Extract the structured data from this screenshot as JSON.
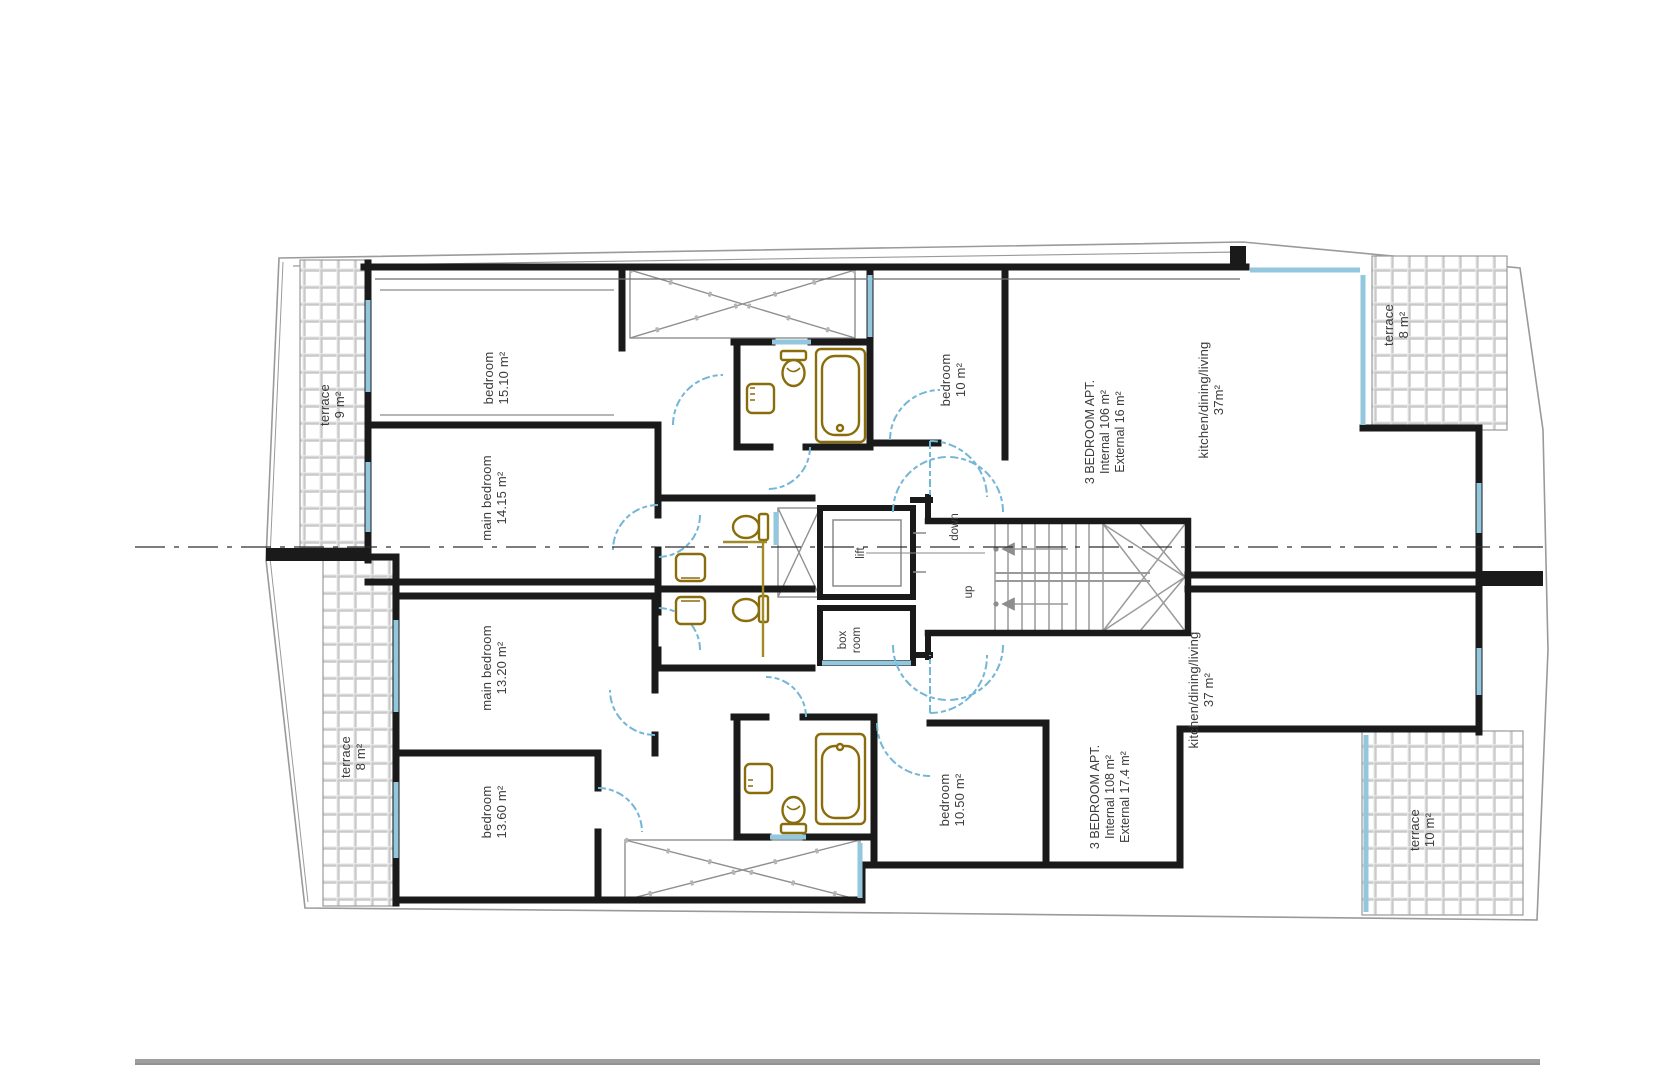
{
  "title": "apartment floor plan",
  "colors": {
    "wall": "#1a1a1a",
    "glazing": "#92c7de",
    "door_swing": "#74b6d6",
    "fixture": "#8a6d0b",
    "tile_grout": "#c9c9c9",
    "boundary": "#9a9a9a",
    "label_text": "#3b3b3b"
  },
  "labels": {
    "terrace_tl": {
      "name": "terrace",
      "area": "9 m²"
    },
    "bedroom_1510": {
      "name": "bedroom",
      "area": "15.10 m²"
    },
    "main_bedroom_1415": {
      "name": "main bedroom",
      "area": "14.15 m²"
    },
    "main_bedroom_1320": {
      "name": "main bedroom",
      "area": "13.20 m²"
    },
    "bedroom_1360": {
      "name": "bedroom",
      "area": "13.60 m²"
    },
    "terrace_bl": {
      "name": "terrace",
      "area": "8 m²"
    },
    "bedroom_10": {
      "name": "bedroom",
      "area": "10 m²"
    },
    "apt_upper": {
      "l1": "3 BEDROOM APT.",
      "l2": "Internal 106  m²",
      "l3": "External 16 m²"
    },
    "kitchen_upper": {
      "name": "kitchen/dining/living",
      "area": "37m²"
    },
    "terrace_tr": {
      "name": "terrace",
      "area": "8 m²"
    },
    "stair_down": "down",
    "stair_up": "up",
    "lift": "lift",
    "box_room": {
      "l1": "box",
      "l2": "room"
    },
    "bedroom_1050": {
      "name": "bedroom",
      "area": "10.50 m²"
    },
    "apt_lower": {
      "l1": "3 BEDROOM APT.",
      "l2": "Internal 108  m²",
      "l3": "External 17.4 m²"
    },
    "kitchen_lower": {
      "name": "kitchen/dining/living",
      "area": "37 m²"
    },
    "terrace_br": {
      "name": "terrace",
      "area": "10 m²"
    }
  }
}
